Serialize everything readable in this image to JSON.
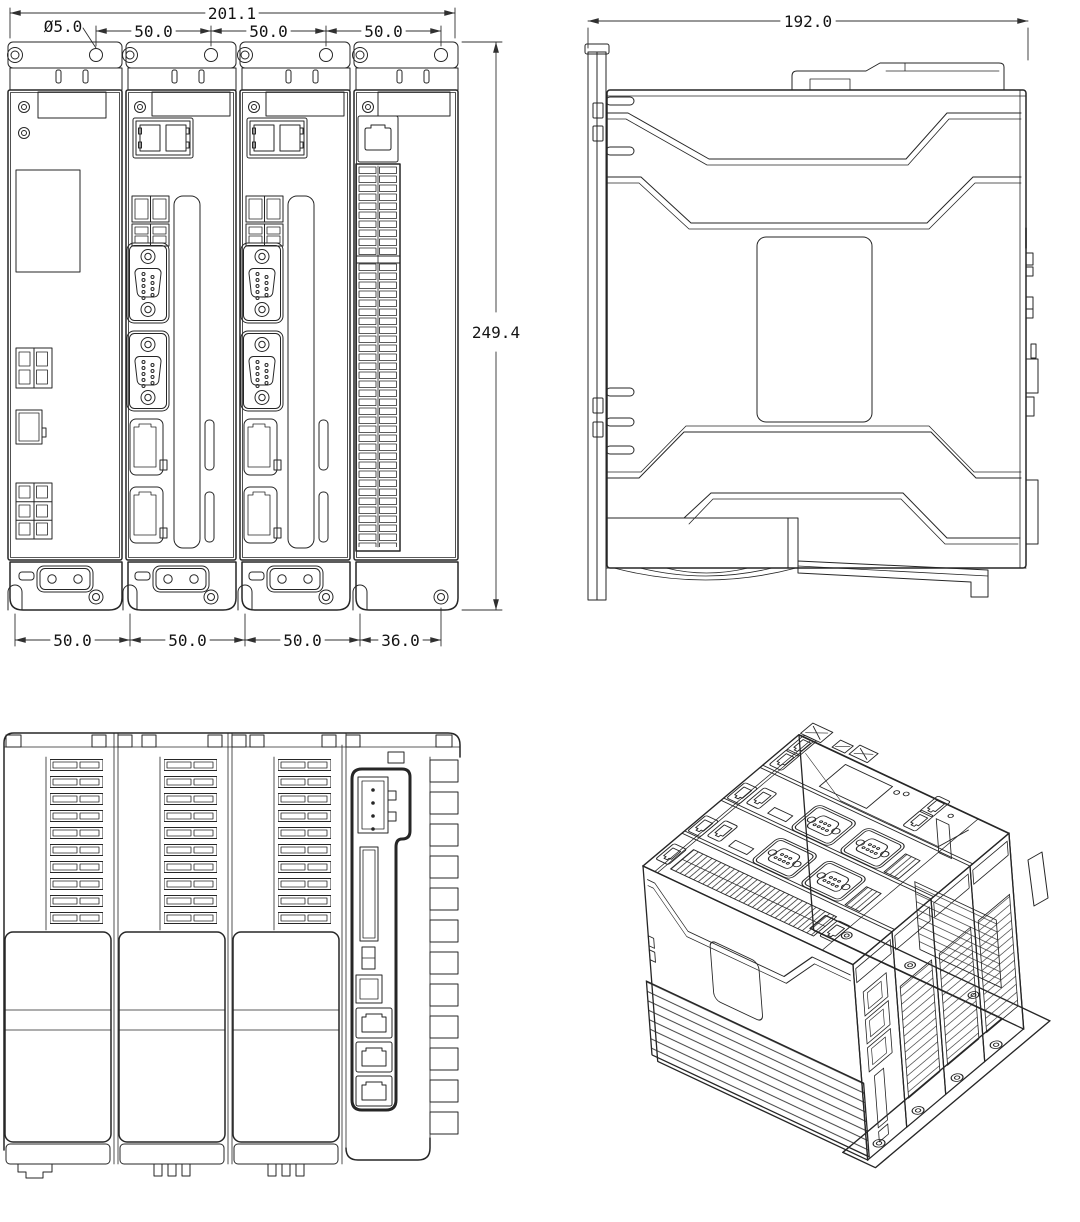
{
  "drawing": {
    "background": "#ffffff",
    "line_color": "#262626",
    "dim_text_color": "#141414",
    "dim": {
      "top_overall": "201.1",
      "hole_diameter": "Ø5.0",
      "top_pitch_a": "50.0",
      "top_pitch_b": "50.0",
      "top_pitch_c": "50.0",
      "height_overall": "249.4",
      "side_depth": "192.0",
      "bottom_pitch_a": "50.0",
      "bottom_pitch_b": "50.0",
      "bottom_pitch_c": "50.0",
      "bottom_last": "36.0"
    }
  }
}
